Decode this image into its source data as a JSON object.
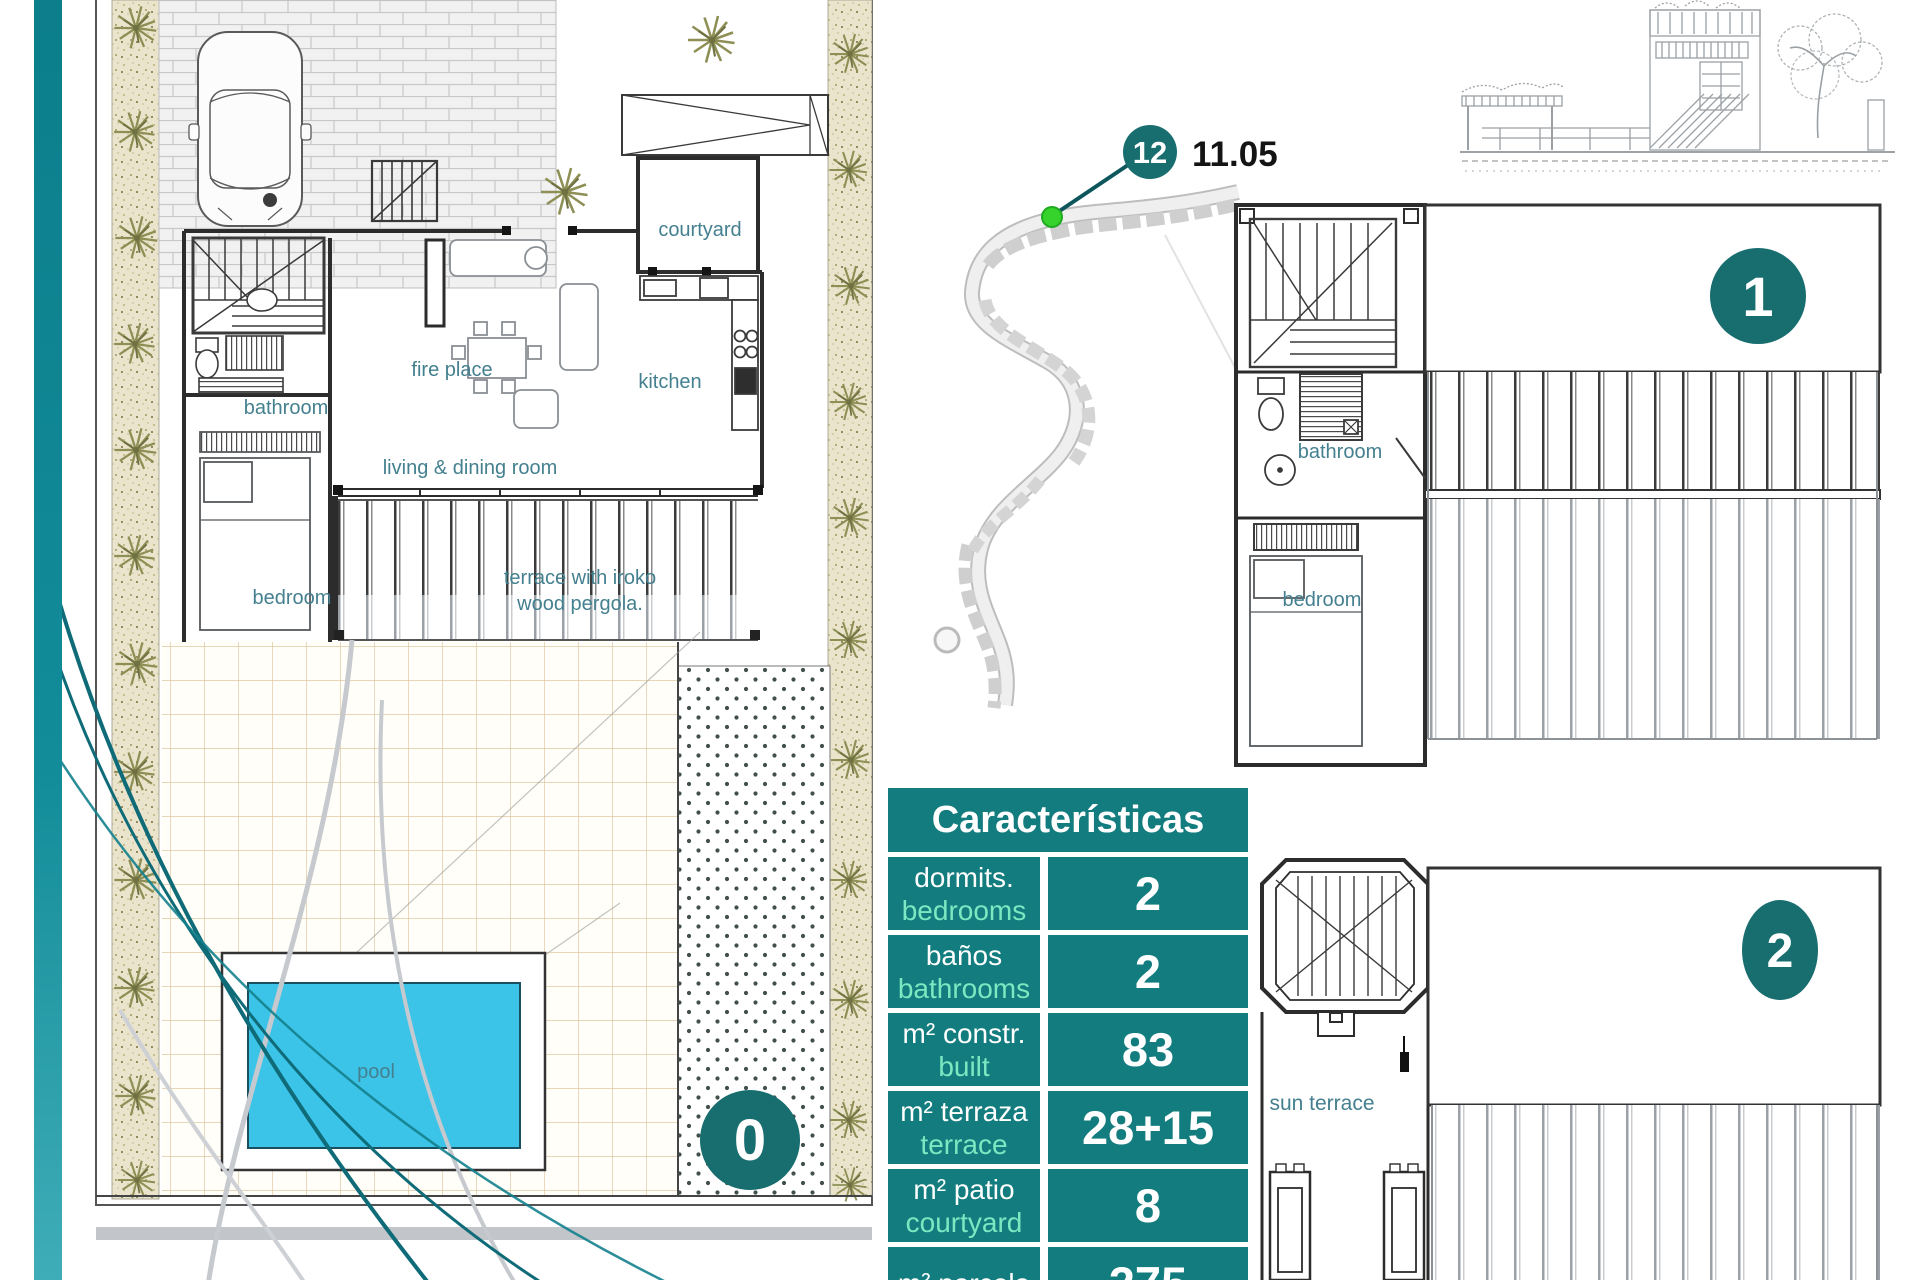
{
  "page": {
    "background": "#ffffff"
  },
  "colors": {
    "table_teal": "#137c7e",
    "accent_mint": "#7ce8c1",
    "level_circle_teal": "#186d6f",
    "sidebar_teal": "#0f8794",
    "room_label_teal": "#44808f",
    "pool_blue": "#3cc3e8",
    "marker_green": "#36d32c"
  },
  "plan0": {
    "level": "0",
    "labels": {
      "courtyard": "courtyard",
      "fire_place": "fire place",
      "kitchen": "kitchen",
      "bathroom": "bathroom",
      "living_dining": "living & dining room",
      "terrace_line1": "terrace with iroko",
      "terrace_line2": "wood pergola.",
      "bedroom": "bedroom",
      "pool": "pool"
    }
  },
  "site_map": {
    "marker_number": "12",
    "elevation_value": "11.05"
  },
  "plan1": {
    "level": "1",
    "labels": {
      "bathroom": "bathroom",
      "bedroom": "bedroom"
    }
  },
  "plan2": {
    "level": "2",
    "labels": {
      "sun_terrace": "sun terrace"
    }
  },
  "features_table": {
    "header": "Características",
    "rows": [
      {
        "es": "dormits.",
        "en": "bedrooms",
        "value": "2"
      },
      {
        "es": "baños",
        "en": "bathrooms",
        "value": "2"
      },
      {
        "es": "m² constr.",
        "en": "built",
        "value": "83"
      },
      {
        "es": "m² terraza",
        "en": "terrace",
        "value": "28+15"
      },
      {
        "es": "m² patio",
        "en": "courtyard",
        "value": "8"
      },
      {
        "es": "m² parcela",
        "en": "",
        "value": "275"
      }
    ]
  }
}
